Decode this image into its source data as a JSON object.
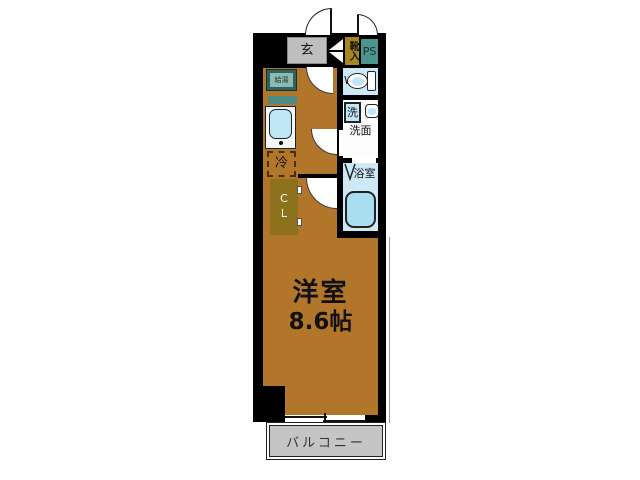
{
  "title": "one-room-apartment-floor-plan",
  "plan": {
    "entrance_label": "玄",
    "shoe_cabinet_label": "靴入",
    "pipe_space_label": "PS",
    "water_heater_label": "給湯",
    "wc_label": "WC",
    "washer_label": "洗",
    "washroom_label": "洗面",
    "bathroom_label": "浴室",
    "fridge_label": "冷",
    "closet_label": "CL",
    "room_label": "洋室",
    "room_size": "8.6帖",
    "balcony_label": "バルコニー"
  },
  "colors": {
    "floor": "#b2762a",
    "wall": "#000000",
    "wet_room_blue": "#cde9f6",
    "fixture_blue": "#bfe6f4",
    "bathtub_blue": "#a8def0",
    "closet_olive": "#8e711d",
    "shoe_cabinet_olive": "#a6861f",
    "pipe_space_teal": "#4d948c",
    "water_heater_teal": "#2f615e",
    "entrance_gray": "#bebebe",
    "balcony_gray": "#c5c5c5"
  }
}
